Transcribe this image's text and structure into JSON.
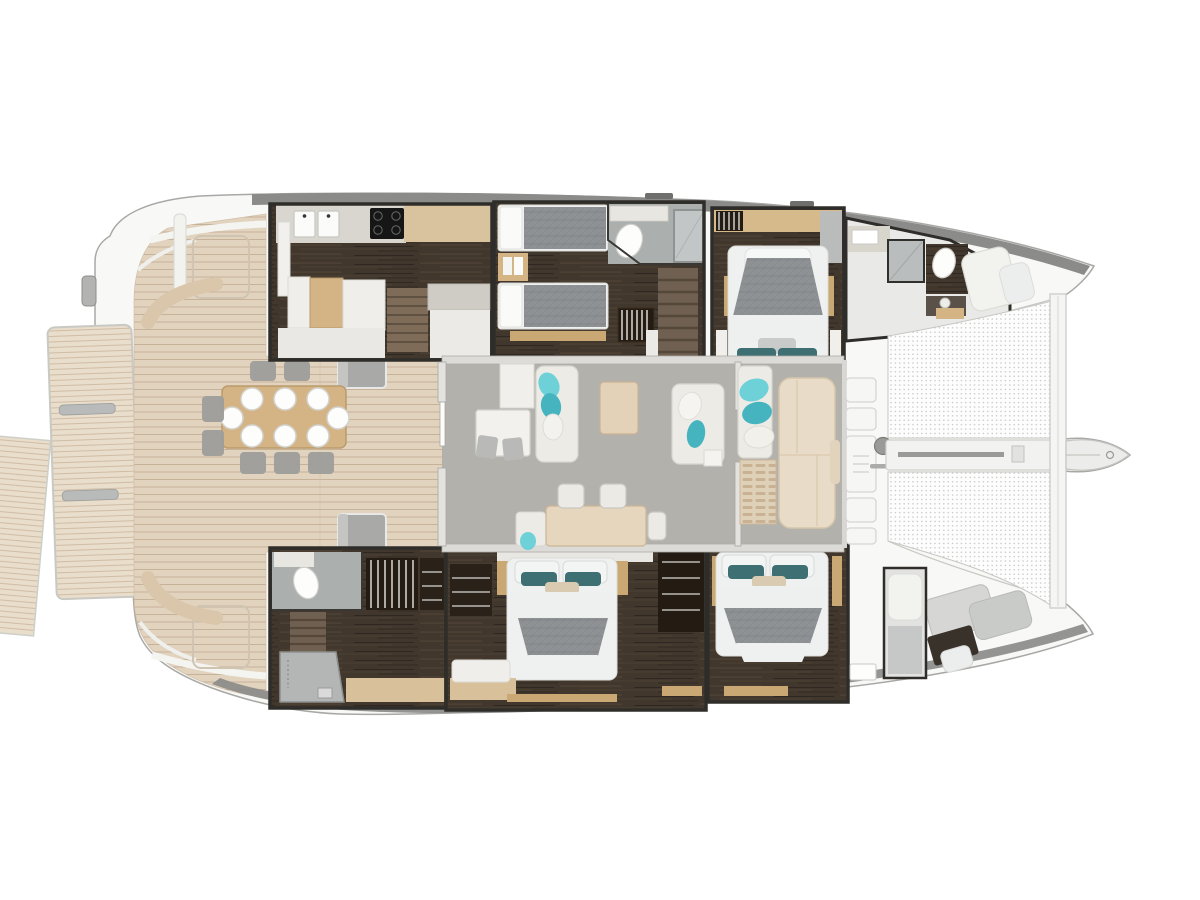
{
  "meta": {
    "view": "top-down floor plan",
    "subject": "sailing catamaran deck and interior layout"
  },
  "palette": {
    "bg": "#ffffff",
    "hull": "#f8f8f6",
    "hull_line": "#a8a8a5",
    "roof_band": "#8b8b89",
    "section_border": "#2f2d29",
    "teak": "#e2d3bf",
    "teak_line": "#c6b299",
    "platform": "#e9ddcb",
    "platform_line": "#cfbda5",
    "dark_floor": "#41372c",
    "dark_floor_hi": "#57493a",
    "saloon_floor": "#b3b1ac",
    "bath_floor": "#abb0af",
    "counter": "#d9d6cf",
    "island": "#cfccc5",
    "wood_light": "#d4b384",
    "wood_trim": "#c9a873",
    "sofa": "#edebe5",
    "sofa_line": "#d6d5cf",
    "cushion_teal": "#6ed1d8",
    "cushion_teal2": "#45b4bf",
    "pillow_teal": "#3e6f72",
    "bed_gray": "#8f9294",
    "bed_white": "#eff1f1",
    "lumbar": "#d9cbb2",
    "net_dot": "#c3c3c1",
    "cooktop": "#161616",
    "appliance": "#b4b6b5",
    "gray_seat": "#9e9e9c",
    "wardrobe_dark": "#241c12",
    "stairs_wood": "#7e6c59",
    "white_item": "#f6f6f4",
    "item_line": "#d5d5d1"
  },
  "areas": [
    {
      "id": "swim-platform",
      "label": "swim platform"
    },
    {
      "id": "aft-deck",
      "label": "aft cockpit deck"
    },
    {
      "id": "cockpit-dining-table",
      "label": "cockpit dining table",
      "place_settings": 8
    },
    {
      "id": "saloon",
      "label": "saloon"
    },
    {
      "id": "galley",
      "label": "galley"
    },
    {
      "id": "nav-station",
      "label": "nav station"
    },
    {
      "id": "saloon-dining-table",
      "label": "saloon dining table"
    },
    {
      "id": "forward-cockpit",
      "label": "forward cockpit lounge"
    },
    {
      "id": "port-twin-cabin",
      "label": "port twin-bed cabin"
    },
    {
      "id": "port-aft-bathroom",
      "label": "port bathroom"
    },
    {
      "id": "port-vip-cabin",
      "label": "port double cabin"
    },
    {
      "id": "port-forward-bathroom",
      "label": "port forward bathroom"
    },
    {
      "id": "starboard-utility",
      "label": "starboard bathroom and laundry"
    },
    {
      "id": "starboard-mid-cabin",
      "label": "starboard double cabin"
    },
    {
      "id": "starboard-forward-cabin",
      "label": "starboard forward double cabin"
    },
    {
      "id": "forepeak-crew",
      "label": "forepeak crew berth"
    },
    {
      "id": "trampoline",
      "label": "bow trampoline"
    },
    {
      "id": "bowsprit",
      "label": "bowsprit"
    },
    {
      "id": "crossbeam",
      "label": "forward crossbeam"
    }
  ],
  "inventory": {
    "double_beds": 4,
    "single_beds": 2,
    "bathrooms": 4,
    "cockpit_seats": 8
  }
}
